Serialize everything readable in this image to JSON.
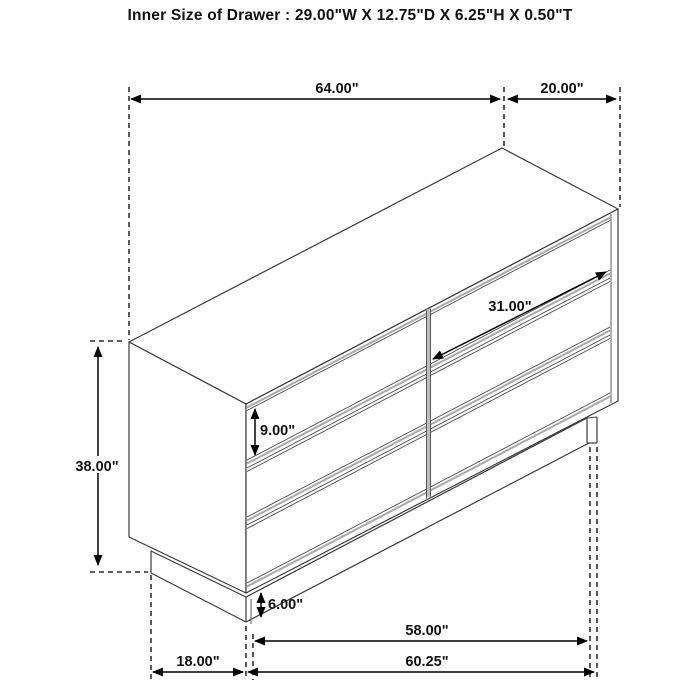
{
  "title": "Inner Size of Drawer : 29.00\"W X 12.75\"D X 6.25\"H X 0.50\"T",
  "dimensions": {
    "overall_width": "64.00\"",
    "overall_depth": "20.00\"",
    "overall_height": "38.00\"",
    "drawer_front_height": "9.00\"",
    "drawer_front_width": "31.00\"",
    "base_height": "6.00\"",
    "base_front_width": "58.00\"",
    "bottom_front_width": "60.25\"",
    "base_side_depth": "18.00\""
  },
  "colors": {
    "background": "#ffffff",
    "furniture_line": "#3a3a3a",
    "dimension_line": "#000000",
    "accent_gray": "#a8a8a8"
  }
}
